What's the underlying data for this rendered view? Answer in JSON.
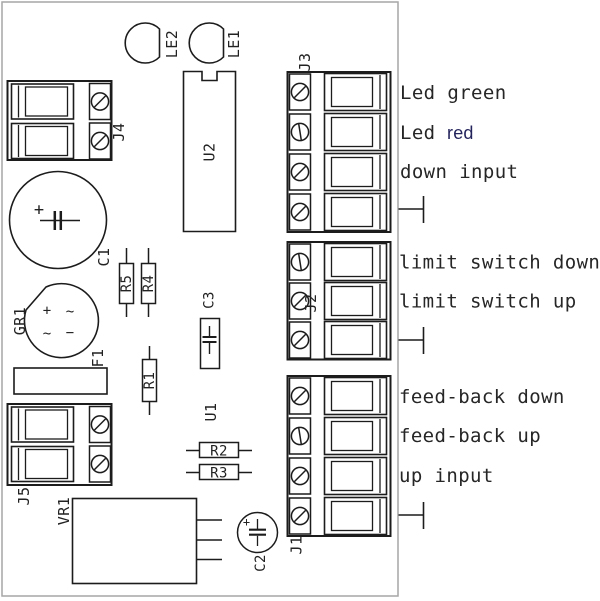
{
  "colors": {
    "component_line": "#1c1c1c",
    "board_outline": "#a6a6a6",
    "label_text": "#262626",
    "led_red_word": "#23235c",
    "background": "#ffffff"
  },
  "components": {
    "j1": "J1",
    "j2": "J2",
    "j3": "J3",
    "j4": "J4",
    "j5": "J5",
    "le1": "LE1",
    "le2": "LE2",
    "u1": "U1",
    "u2": "U2",
    "c1": "C1",
    "c2": "C2",
    "c3": "C3",
    "gr1": "GR1",
    "f1": "F1",
    "vr1": "VR1",
    "r1": "R1",
    "r2": "R2",
    "r3": "R3",
    "r4": "R4",
    "r5": "R5"
  },
  "marks": {
    "c1_plus": "+",
    "c2_plus": "+",
    "gr1_plus": "+",
    "gr1_tilde_a": "~",
    "gr1_tilde_b": "~",
    "gr1_minus": "−"
  },
  "pin_labels": {
    "led_green": "Led green",
    "led_red_prefix": "Led",
    "led_red_word": "red",
    "down_input": "down input",
    "limit_switch_down": "limit switch down",
    "limit_switch_up": "limit switch up",
    "feed_back_down": "feed-back down",
    "feed_back_up": "feed-back up",
    "up_input": "up input"
  }
}
